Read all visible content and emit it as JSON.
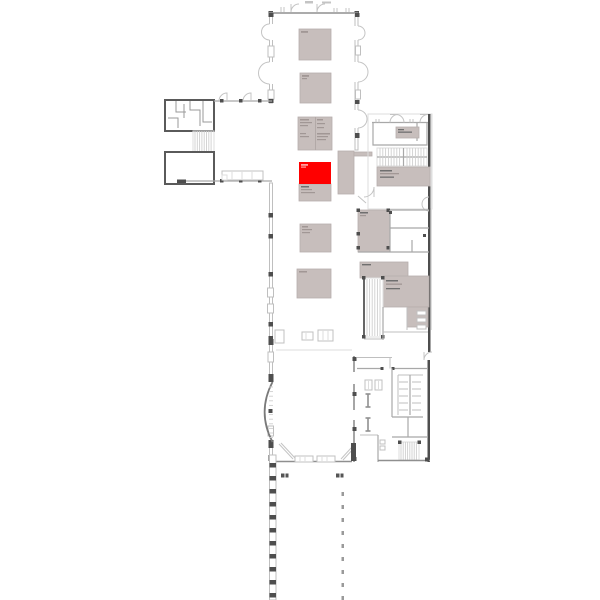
{
  "palette": {
    "background": "#ffffff",
    "room_fill": "#c7bebc",
    "room_border": "#b7aeac",
    "highlight": "#ff0000",
    "highlight_text": "#ff9f9f",
    "wall_dark": "#4e4e4e",
    "wall_mid": "#8f8f8f",
    "wall_light": "#bfbfbf",
    "hatch": "#cfcfcf",
    "micro_text": "#a19795",
    "micro_text_dark": "#6f6f6f"
  },
  "plan": {
    "type": "building-floor-plan",
    "highlighted_room": {
      "status": "selected",
      "color": "#ff0000"
    }
  }
}
